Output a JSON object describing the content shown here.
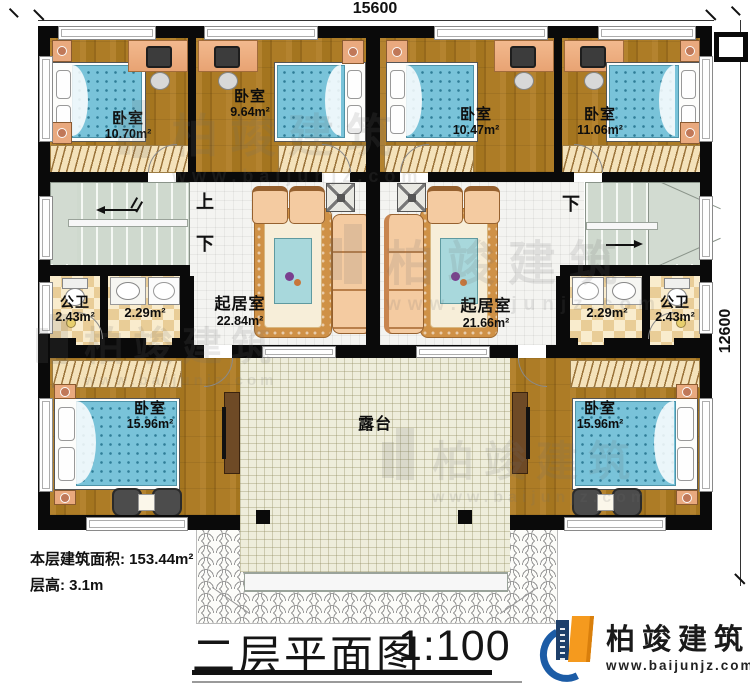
{
  "dimensions": {
    "top": "15600",
    "right": "12600"
  },
  "rooms": {
    "bedroom_tl": {
      "label": "卧室",
      "area": "10.70m²"
    },
    "bedroom_tml": {
      "label": "卧室",
      "area": "9.64m²"
    },
    "bedroom_tmr": {
      "label": "卧室",
      "area": "10.47m²"
    },
    "bedroom_tr": {
      "label": "卧室",
      "area": "11.06m²"
    },
    "living_left": {
      "label": "起居室",
      "area": "22.84m²"
    },
    "living_right": {
      "label": "起居室",
      "area": "21.66m²"
    },
    "bath_left": {
      "label": "公卫",
      "area": "2.43m²"
    },
    "bath_right": {
      "label": "公卫",
      "area": "2.43m²"
    },
    "wash_left": {
      "area": "2.29m²"
    },
    "wash_right": {
      "area": "2.29m²"
    },
    "bedroom_bl": {
      "label": "卧室",
      "area": "15.96m²"
    },
    "bedroom_br": {
      "label": "卧室",
      "area": "15.96m²"
    },
    "terrace": {
      "label": "露台"
    }
  },
  "stairs": {
    "up": "上",
    "down": "下"
  },
  "footer": {
    "area_line": "本层建筑面积: 153.44m²",
    "height_line": "层高: 3.1m"
  },
  "title": {
    "text": "二层平面图",
    "scale": "1:100"
  },
  "brand": {
    "name": "柏竣建筑",
    "url": "www.baijunjz.com"
  }
}
